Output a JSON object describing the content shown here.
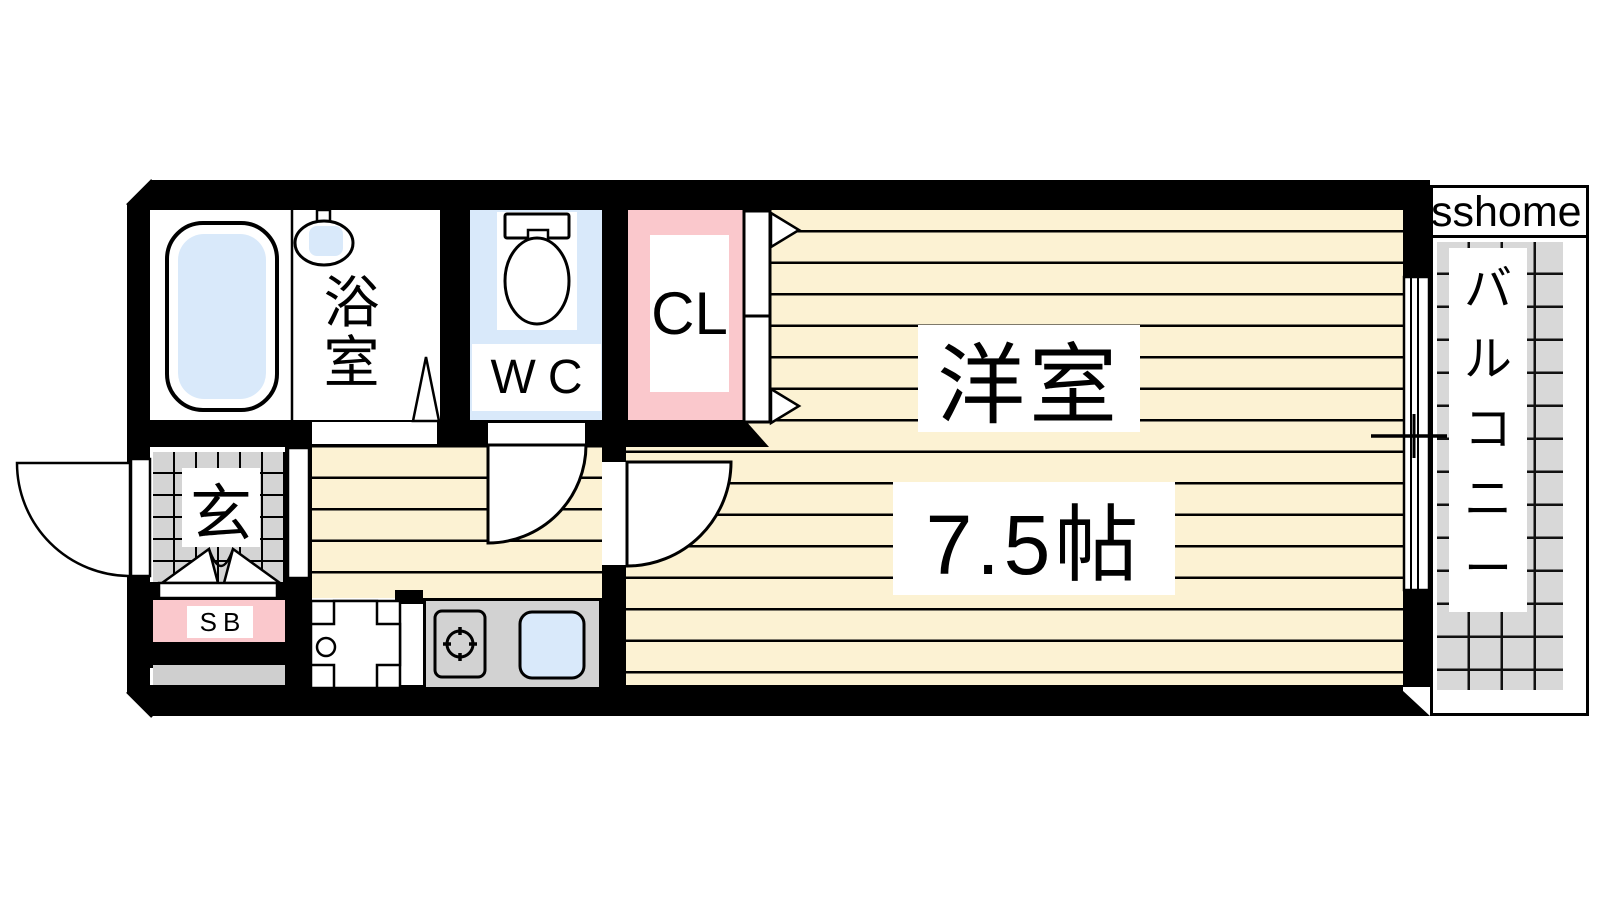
{
  "watermark": "sshome",
  "rooms": {
    "bathroom": {
      "label": "浴室"
    },
    "toilet": {
      "label": "WC"
    },
    "closet": {
      "label": "CL"
    },
    "main_room": {
      "label": "洋室",
      "size": "7.5帖"
    },
    "entrance": {
      "label": "玄"
    },
    "shoe_box": {
      "label": "SB"
    },
    "balcony": {
      "label": "バルコニー"
    }
  },
  "colors": {
    "wall": "#000000",
    "floor_cream": "#fcf2d3",
    "water_blue": "#d9e9fa",
    "closet_pink": "#fac8cc",
    "tile_gray": "#d4d4d4",
    "balcony_gray": "#d8d8d8"
  }
}
